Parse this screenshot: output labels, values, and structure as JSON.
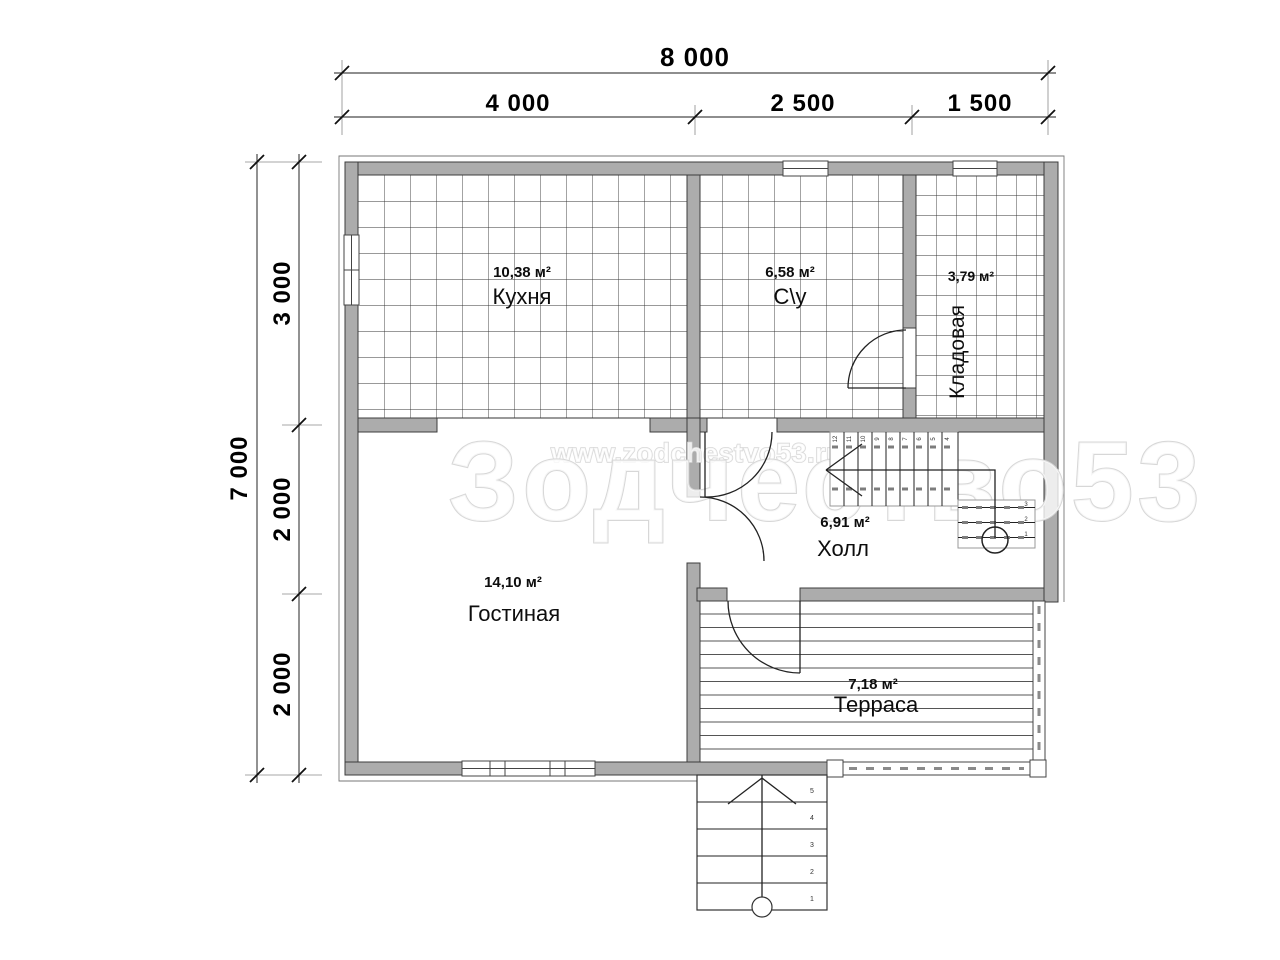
{
  "watermark": {
    "url_text": "www.zodchestvo53.ru",
    "brand_text": "Зодчество53"
  },
  "dimensions": {
    "top_total": "8 000",
    "top_segments": [
      "4 000",
      "2 500",
      "1 500"
    ],
    "left_total": "7 000",
    "left_segments": [
      "3 000",
      "2 000",
      "2 000"
    ]
  },
  "rooms": [
    {
      "area": "10,38 м²",
      "name": "Кухня"
    },
    {
      "area": "6,58 м²",
      "name": "С\\у"
    },
    {
      "area": "3,79 м²",
      "name": "Кладовая"
    },
    {
      "area": "6,91 м²",
      "name": "Холл"
    },
    {
      "area": "14,10 м²",
      "name": "Гостиная"
    },
    {
      "area": "7,18 м²",
      "name": "Терраса"
    }
  ],
  "stairs": {
    "hall_upper_treads": [
      "12",
      "11",
      "10",
      "9",
      "8",
      "7",
      "6",
      "5",
      "4"
    ],
    "hall_lower_treads": [
      "3",
      "2",
      "1"
    ],
    "entrance_treads": [
      "5",
      "4",
      "3",
      "2",
      "1"
    ]
  },
  "colors": {
    "wall": "#acacac",
    "line": "#1a1a1a",
    "watermark": "#d7d7d7"
  }
}
